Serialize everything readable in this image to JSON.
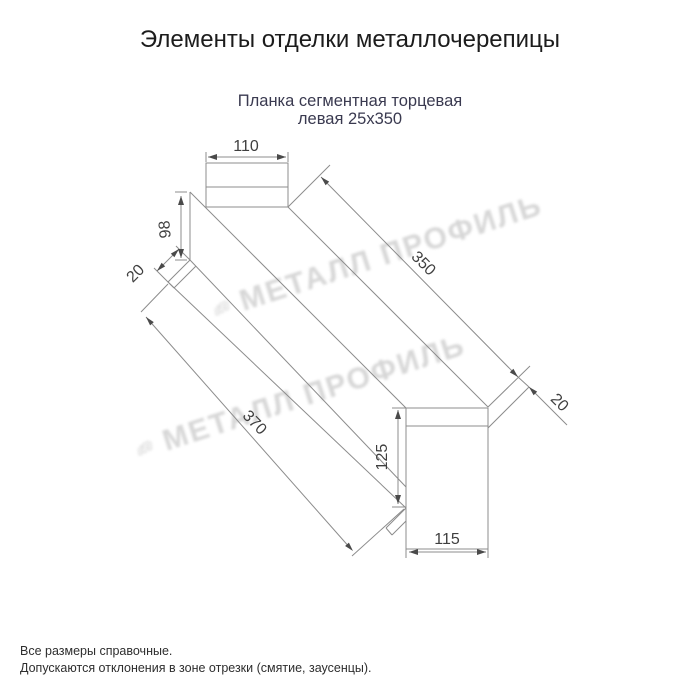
{
  "header": {
    "title": "Элементы отделки металлочерепицы"
  },
  "product": {
    "name_line1": "Планка сегментная торцевая",
    "name_line2": "левая 25х350"
  },
  "drawing": {
    "dims": {
      "top_flange_width": "110",
      "back_height": "98",
      "left_fold": "20",
      "top_length": "350",
      "right_fold": "20",
      "bottom_length": "370",
      "end_height": "125",
      "end_width": "115"
    }
  },
  "watermark": {
    "text": "МЕТАЛЛ ПРОФИЛЬ"
  },
  "footer": {
    "note1": "Все размеры справочные.",
    "note2": "Допускаются отклонения в зоне отрезки (смятие, заусенцы)."
  },
  "colors": {
    "subtitle": "#3a3a50",
    "line": "#8c8c8c",
    "dim_text": "#3f3f3f",
    "watermark": "#d0d0d0"
  }
}
